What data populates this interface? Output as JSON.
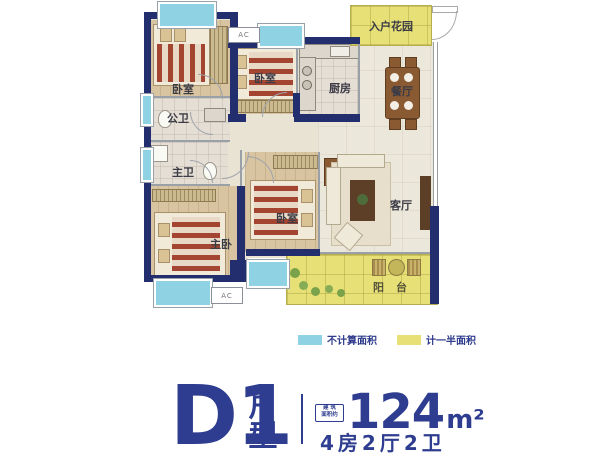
{
  "colors": {
    "wall_navy": "#232e6e",
    "text_navy": "#2e3d8f",
    "window_blue": "#8ed2e4",
    "half_area_yellow": "#e7e076",
    "label_dark": "#3b3b46"
  },
  "plan": {
    "rooms": [
      {
        "id": "bedroom-top-left",
        "label": "卧室"
      },
      {
        "id": "bedroom-top-mid",
        "label": "卧室"
      },
      {
        "id": "public-bath",
        "label": "公卫"
      },
      {
        "id": "kitchen",
        "label": "厨房"
      },
      {
        "id": "dining",
        "label": "餐厅"
      },
      {
        "id": "master-bath",
        "label": "主卫"
      },
      {
        "id": "master-bedroom",
        "label": "主卧"
      },
      {
        "id": "bedroom-center",
        "label": "卧室"
      },
      {
        "id": "living",
        "label": "客厅"
      },
      {
        "id": "balcony",
        "label": "阳台"
      },
      {
        "id": "entry-garden",
        "label": "入户花园"
      }
    ],
    "ac_label": "AC"
  },
  "legend": {
    "items": [
      {
        "label": "不计算面积",
        "color": "#8ed2e4"
      },
      {
        "label": "计一半面积",
        "color": "#e7e076"
      }
    ]
  },
  "title": {
    "model": "D1",
    "model_suffix": "户型",
    "badge_line1": "建 筑",
    "badge_line2": "面积约",
    "area_value": "124",
    "area_unit": "m²",
    "layout_text": "4房2厅2卫"
  }
}
